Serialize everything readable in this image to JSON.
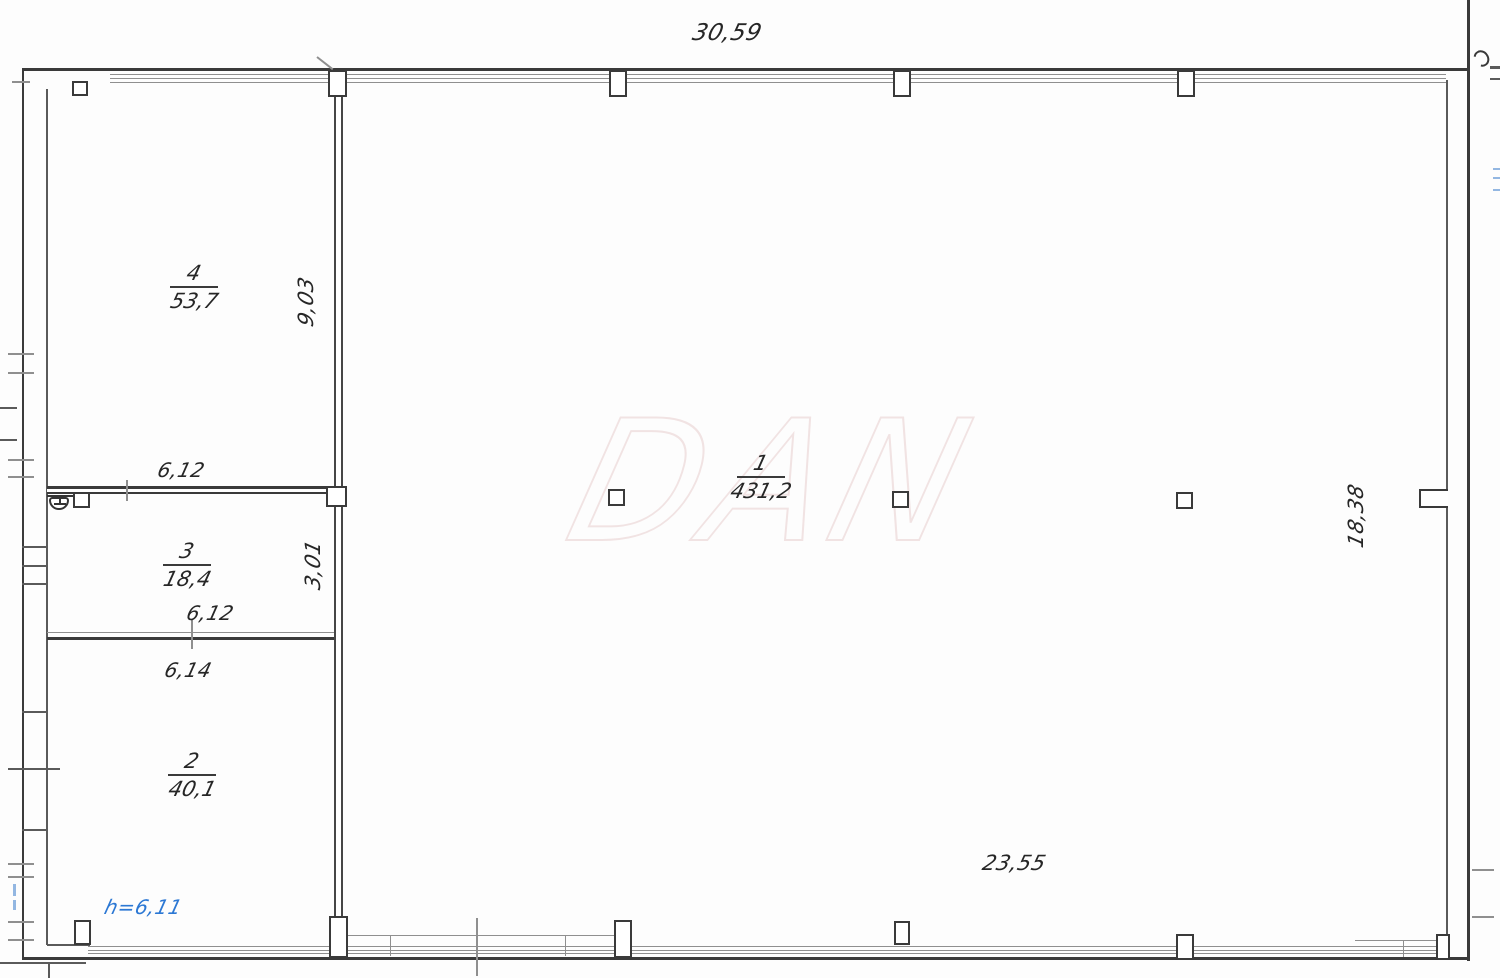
{
  "colors": {
    "line_dark": "#3a3a3a",
    "line_light": "#8f8f8f",
    "text": "#262626",
    "accent_blue": "#2c78d4",
    "watermark": "#f1e3e3"
  },
  "watermark_text": "DAN",
  "rooms": [
    {
      "number": "1",
      "area": "431,2"
    },
    {
      "number": "2",
      "area": "40,1"
    },
    {
      "number": "3",
      "area": "18,4"
    },
    {
      "number": "4",
      "area": "53,7"
    }
  ],
  "dimensions": {
    "overall_width": "30,59",
    "hall_height": "18,38",
    "hall_bottom_width": "23,55",
    "room4_height": "9,03",
    "room4_width": "6,12",
    "room3_height": "3,01",
    "room3_width": "6,12",
    "room2_width": "6,14",
    "ceiling_height_note": "h=6,11"
  }
}
